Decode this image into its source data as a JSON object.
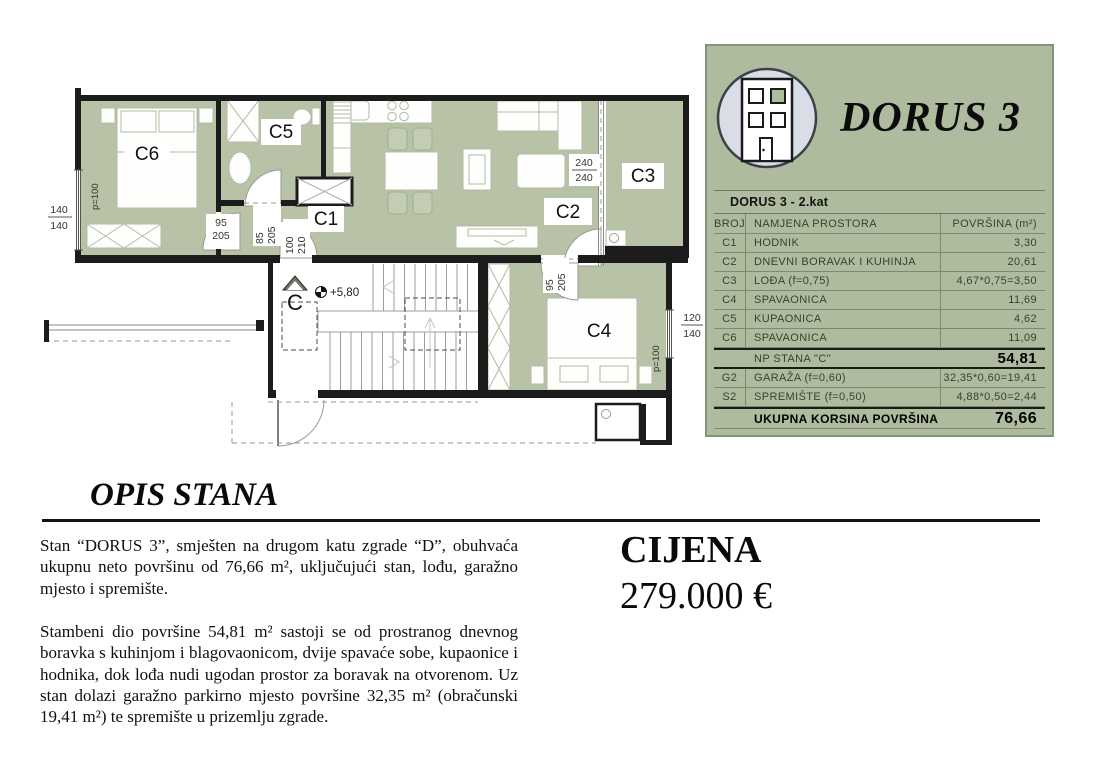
{
  "panel": {
    "title": "DORUS 3",
    "logo_icon": "building-icon",
    "table": {
      "header": "DORUS 3 - 2.kat",
      "columns": [
        "BROJ",
        "NAMJENA PROSTORA",
        "POVRŠINA (m²)"
      ],
      "rows": [
        {
          "broj": "C1",
          "namjena": "HODNIK",
          "povrsina": "3,30"
        },
        {
          "broj": "C2",
          "namjena": "DNEVNI BORAVAK I KUHINJA",
          "povrsina": "20,61"
        },
        {
          "broj": "C3",
          "namjena": "LOĐA (f=0,75)",
          "povrsina": "4,67*0,75=3,50"
        },
        {
          "broj": "C4",
          "namjena": "SPAVAONICA",
          "povrsina": "11,69"
        },
        {
          "broj": "C5",
          "namjena": "KUPAONICA",
          "povrsina": "4,62"
        },
        {
          "broj": "C6",
          "namjena": "SPAVAONICA",
          "povrsina": "11,09"
        }
      ],
      "np_row": {
        "label": "NP STANA \"C\"",
        "value": "54,81"
      },
      "extra_rows": [
        {
          "broj": "G2",
          "namjena": "GARAŽA (f=0,60)",
          "povrsina": "32,35*0,60=19,41"
        },
        {
          "broj": "S2",
          "namjena": "SPREMIŠTE (f=0,50)",
          "povrsina": "4,88*0,50=2,44"
        }
      ],
      "total_row": {
        "label": "UKUPNA KORSINA POVRŠINA",
        "value": "76,66"
      }
    }
  },
  "plan": {
    "rooms": {
      "c1": "C1",
      "c2": "C2",
      "c3": "C3",
      "c4": "C4",
      "c5": "C5",
      "c6": "C6"
    },
    "windows": {
      "left": [
        "140",
        "140"
      ],
      "right": [
        "120",
        "140"
      ],
      "balcony": [
        "240",
        "240"
      ],
      "parapet_left": "p=100",
      "parapet_right": "p=100"
    },
    "doors": {
      "c6": [
        "95",
        "205"
      ],
      "c5": [
        "85",
        "205"
      ],
      "entry": [
        "100",
        "210"
      ],
      "c4": [
        "95",
        "205"
      ]
    },
    "stairs": {
      "section_mark": "C",
      "elevation": "+5,80"
    }
  },
  "description": {
    "heading": "OPIS STANA",
    "para1": "Stan “DORUS 3”, smješten na drugom katu zgrade “D”, obuhvaća ukupnu neto površinu od 76,66 m², uključujući stan, lođu, garažno mjesto i spremište.",
    "para2": "Stambeni dio površine 54,81 m² sastoji se od prostranog dnevnog boravka s kuhinjom i blagovaonicom, dvije spavaće sobe, kupaonice i hodnika, dok lođa nudi ugodan prostor za boravak na otvorenom. Uz stan dolazi garažno parkirno mjesto površine 32,35 m² (obračunski 19,41 m²) te spremište u prizemlju zgrade."
  },
  "price": {
    "label": "CIJENA",
    "value": "279.000 €"
  },
  "colors": {
    "plan_green": "#b7c2a7",
    "panel_green": "#afbb9e",
    "wall": "#1c1c1c",
    "accent_border": "#87927a"
  }
}
